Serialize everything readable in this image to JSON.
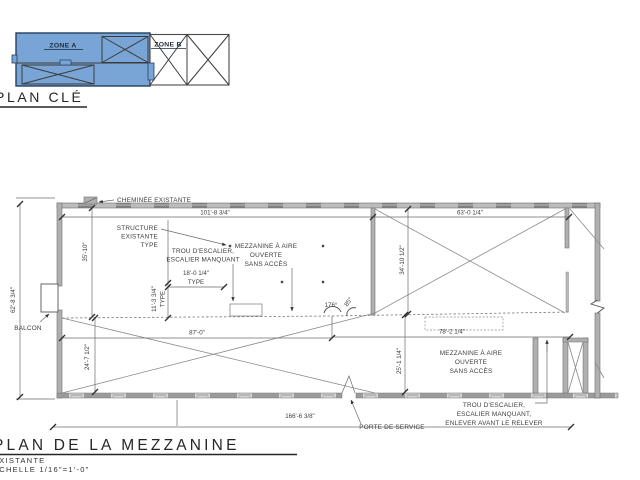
{
  "key_plan": {
    "title": "PLAN CLÉ",
    "zone_a": "ZONE A",
    "zone_b": "ZONE B",
    "zone_a_fill_color": "#79a5d6"
  },
  "main_plan": {
    "labels": {
      "cheminee": "CHEMINÉE EXISTANTE",
      "structure": [
        "STRUCTURE",
        "EXISTANTE",
        "TYPE"
      ],
      "trou_escalier_1": [
        "TROU D'ESCALIER,",
        "ESCALIER MANQUANT"
      ],
      "mezzanine_1": [
        "MEZZANINE À AIRE",
        "OUVERTE",
        "SANS ACCÈS"
      ],
      "balcon": "BALCON",
      "mezzanine_2": [
        "MEZZANINE À AIRE",
        "OUVERTE",
        "SANS ACCÈS"
      ],
      "trou_escalier_2": [
        "TROU D'ESCALIER,",
        "ESCALIER MANQUANT,",
        "ENLEVER AVANT LE RELEVER"
      ],
      "porte_service": "PORTE DE SERVICE"
    },
    "dimensions": {
      "top_left": "101'-8 3/4\"",
      "top_right": "63'-0 1/4\"",
      "overall_left": "62'-8 3/4\"",
      "left_upper": "35'-10\"",
      "right_upper": "34'-10 1/2\"",
      "bay_width": "18'-0 1/4\"",
      "bay_width_note": "TYPE",
      "bay_depth": "11'-3 3/4\"",
      "bay_depth_note": "TYPE",
      "angle_main": "176°",
      "angle_small": "85°",
      "mid_left": "87'-0\"",
      "mid_right": "78'-2 1/4\"",
      "lower_left": "24'-7 1/2\"",
      "lower_right": "25'-1 1/4\"",
      "overall_bottom": "166'-6 3/8\""
    }
  },
  "title_block": {
    "title": "PLAN DE LA MEZZANINE",
    "subtitle": "EXISTANTE",
    "scale": "ÉCHELLE 1/16\"=1'-0\""
  },
  "line_color": "#555555",
  "wall_color": "#b0b0b0"
}
